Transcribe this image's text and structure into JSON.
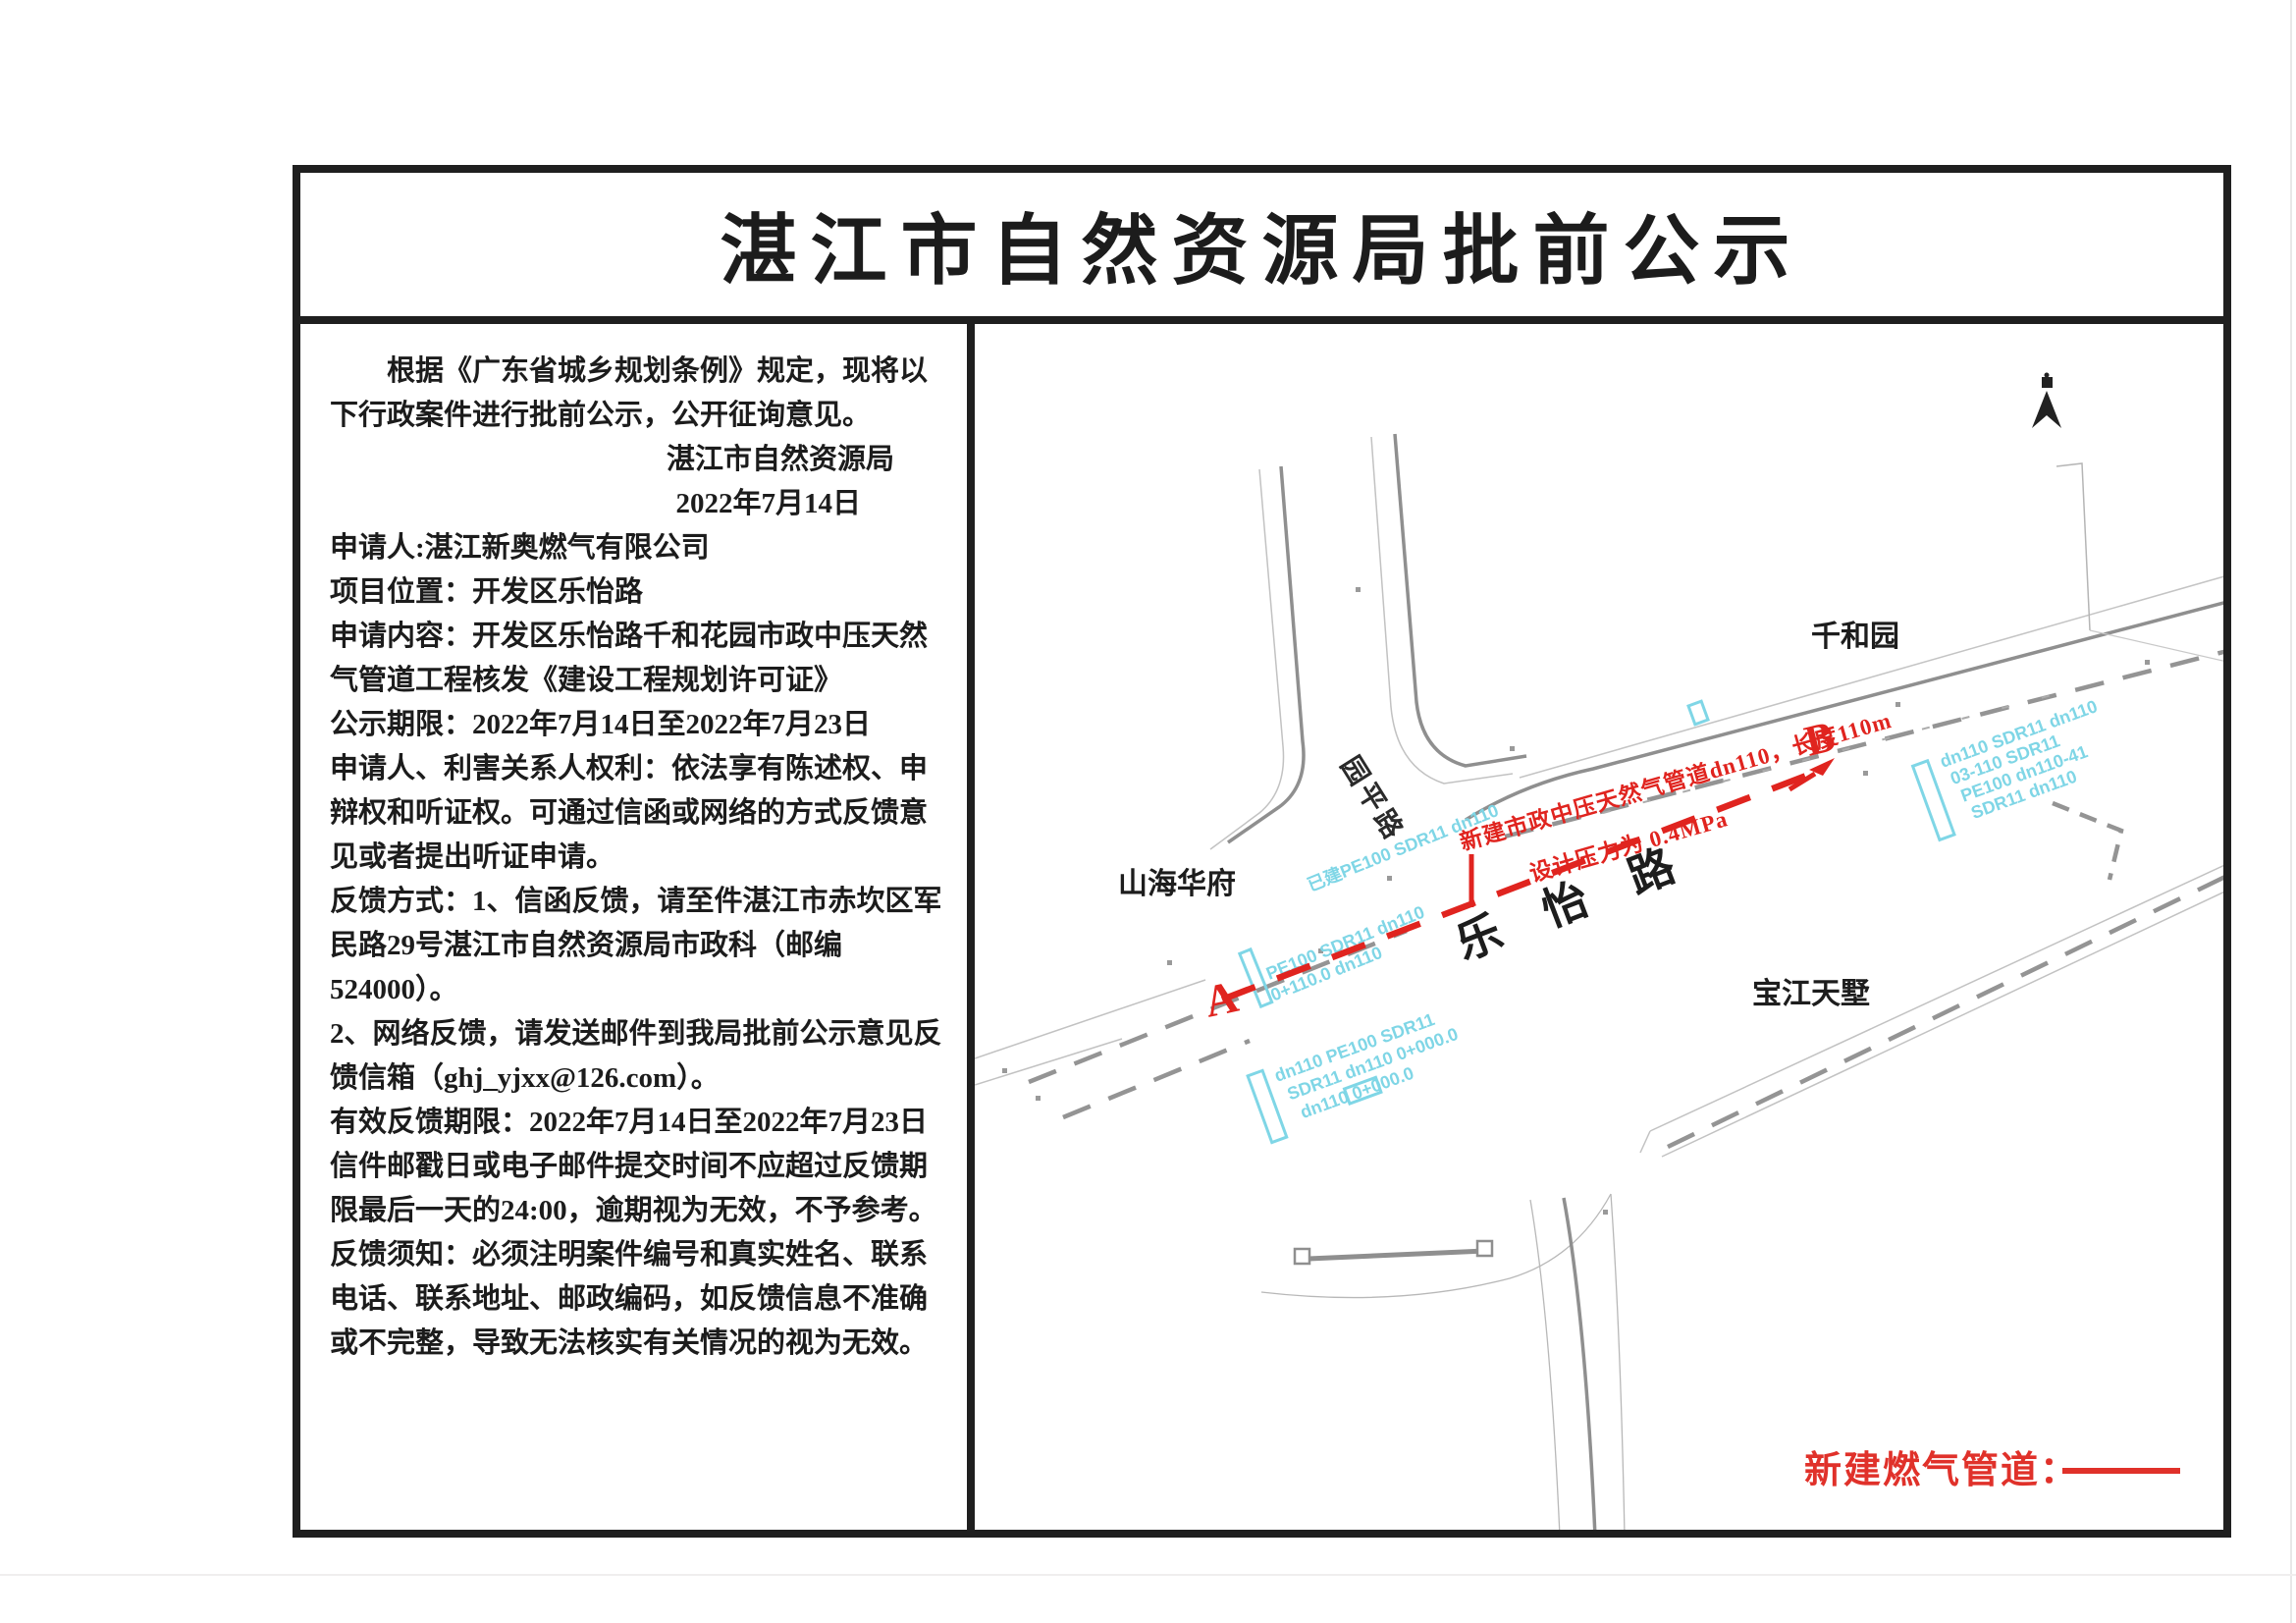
{
  "title": "湛江市自然资源局批前公示",
  "notice": {
    "intro": "根据《广东省城乡规划条例》规定，现将以下行政案件进行批前公示，公开征询意见。",
    "issuer": "湛江市自然资源局",
    "issue_date": "2022年7月14日",
    "applicant": "申请人:湛江新奥燃气有限公司",
    "location": "项目位置：开发区乐怡路",
    "content": "申请内容：开发区乐怡路千和花园市政中压天然气管道工程核发《建设工程规划许可证》",
    "period": "公示期限：2022年7月14日至2022年7月23日",
    "rights": "申请人、利害关系人权利：依法享有陈述权、申辩权和听证权。可通过信函或网络的方式反馈意见或者提出听证申请。",
    "feedback_mail": "反馈方式：1、信函反馈，请至件湛江市赤坎区军民路29号湛江市自然资源局市政科（邮编524000）。",
    "feedback_online": "2、网络反馈，请发送邮件到我局批前公示意见反馈信箱（ghj_yjxx@126.com）。",
    "valid_period": "有效反馈期限：2022年7月14日至2022年7月23日",
    "deadline_note": "信件邮戳日或电子邮件提交时间不应超过反馈期限最后一天的24:00，逾期视为无效，不予参考。",
    "requirement_note": "反馈须知：必须注明案件编号和真实姓名、联系电话、联系地址、邮政编码，如反馈信息不准确或不完整，导致无法核实有关情况的视为无效。"
  },
  "map": {
    "labels": {
      "qianheyuan": "千和园",
      "shanhaihuafu": "山海华府",
      "baojiangtianshu": "宝江天墅",
      "side_road": "园平路",
      "main_road": "乐怡路"
    },
    "markers": {
      "start": "A",
      "end": "B"
    },
    "pipe_note_line1": "新建市政中压天然气管道dn110，长度110m",
    "pipe_note_line2": "设计压力为 0.4MPa",
    "legend_label": "新建燃气管道：",
    "existing_pipes": {
      "clusterA": [
        "已建PE100 SDR11 dn110",
        "PE100 SDR11 dn110",
        "0+110.0 dn110"
      ],
      "clusterA2": [
        "dn110 PE100 SDR11",
        "SDR11 dn110 0+000.0",
        "dn110 0+000.0"
      ],
      "clusterB": [
        "dn110 SDR11 dn110",
        "03-110 SDR11",
        "PE100 dn110-41",
        "SDR11 dn110"
      ]
    },
    "colors": {
      "new_pipe": "#e0241f",
      "existing_pipe": "#7fd6e6",
      "road_dark": "#8f8f8f",
      "road_light": "#c2c2c2"
    }
  }
}
